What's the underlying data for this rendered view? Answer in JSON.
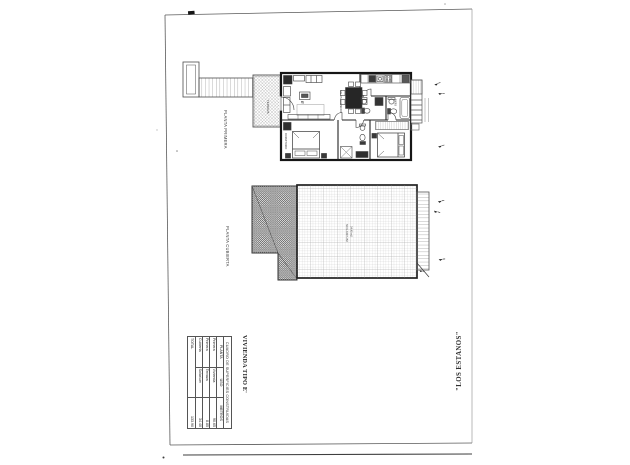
{
  "labels": {
    "planta_primera": "PLANTA PRIMERA",
    "planta_cubierta": "PLANTA CUBIERTA",
    "vivienda_tipo": "VIVIENDA TIPO E'",
    "project_name": "\"LOS ESTANOS\"",
    "door_label": "E'"
  },
  "plan_primera": {
    "rooms": {
      "terraza": "TERRAZA",
      "salon": "SALON-COMEDOR",
      "bano": "BAÑO",
      "dormitorio": "DORMITORIO"
    }
  },
  "plan_cubierta": {
    "solarium": "SOLARIUM",
    "solarium_area": "34.40 m2"
  },
  "surfaces_table": {
    "title": "CUADRO DE SUPERFICIES CONSTRUIDAS",
    "headers": [
      "PLANTA",
      "USO",
      "METROS"
    ],
    "rows": [
      {
        "planta": "Primera",
        "uso": "Vivienda",
        "metros": "90.65"
      },
      {
        "planta": "Primera",
        "uso": "Terraza",
        "metros": "8.85"
      },
      {
        "planta": "Cubierta",
        "uso": "Solarium",
        "metros": "34.40"
      }
    ],
    "total_label": "TOTAL",
    "total_value": "133.90"
  },
  "colors": {
    "wall_ink": "#1a1a1a",
    "line_ink": "#444444",
    "hatch": "#8f8f8f"
  }
}
